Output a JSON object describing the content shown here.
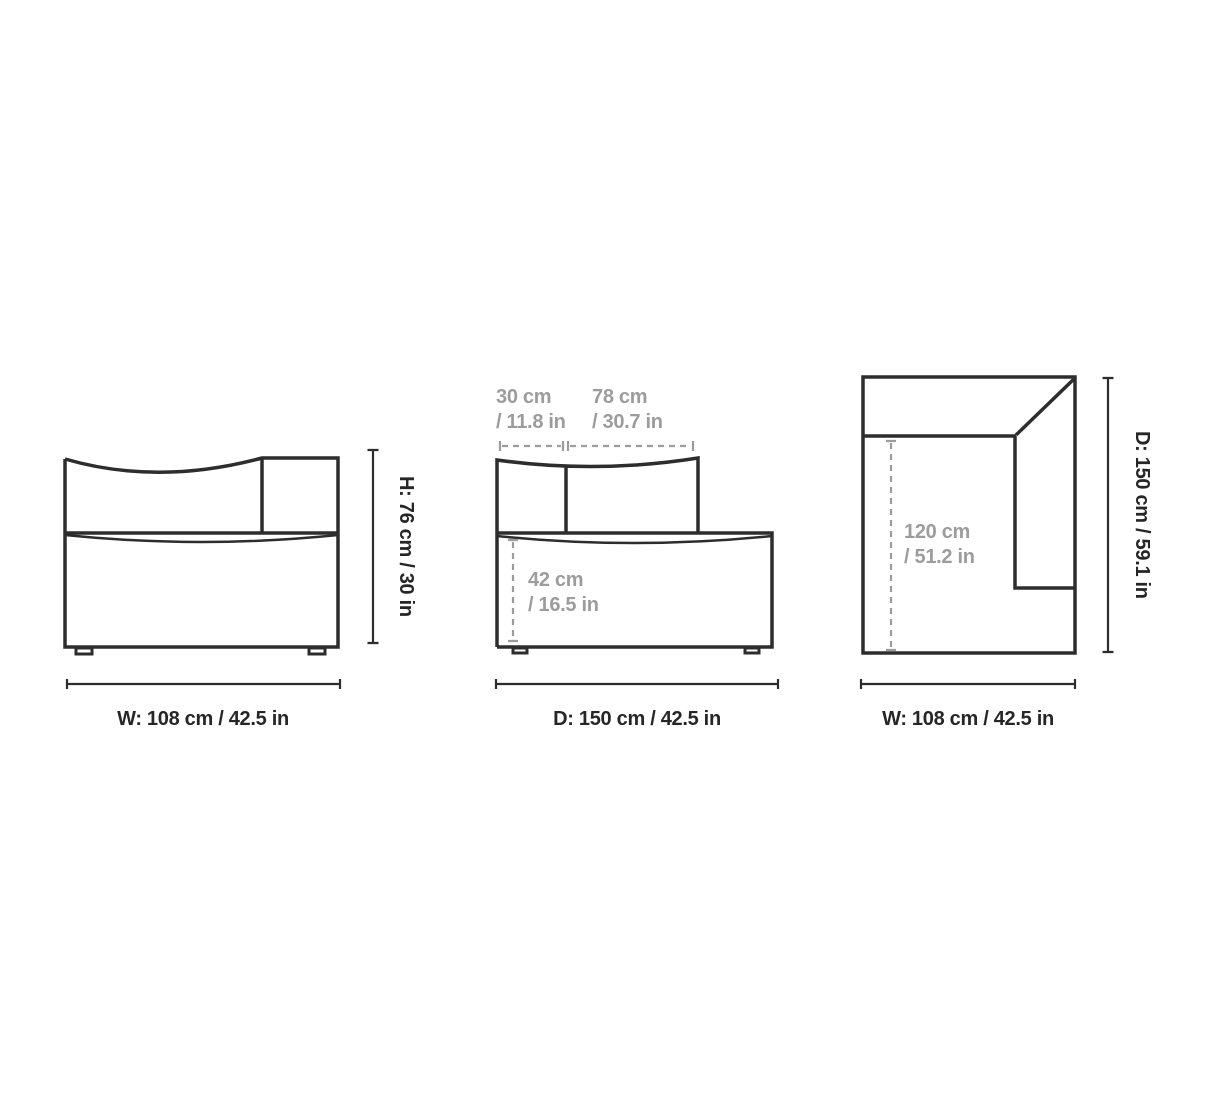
{
  "colors": {
    "line": "#2d2d2d",
    "text_dark": "#262626",
    "text_muted": "#9c9c9c",
    "background": "#ffffff"
  },
  "diagram": {
    "kind": "furniture-dimension-drawing",
    "views": {
      "front": {
        "title": "front-view",
        "labels": {
          "height": "H: 76 cm / 30 in",
          "width": "W: 108 cm / 42.5 in"
        }
      },
      "side": {
        "title": "side-view",
        "labels": {
          "back_depth": "30 cm\n/ 11.8 in",
          "seat_depth": "78 cm\n/ 30.7 in",
          "seat_height": "42 cm\n/ 16.5 in",
          "depth": "D: 150 cm / 42.5 in"
        }
      },
      "top": {
        "title": "top-view",
        "labels": {
          "inner_depth": "120 cm\n/ 51.2 in",
          "depth": "D: 150 cm / 59.1 in",
          "width": "W: 108 cm / 42.5 in"
        }
      }
    }
  }
}
